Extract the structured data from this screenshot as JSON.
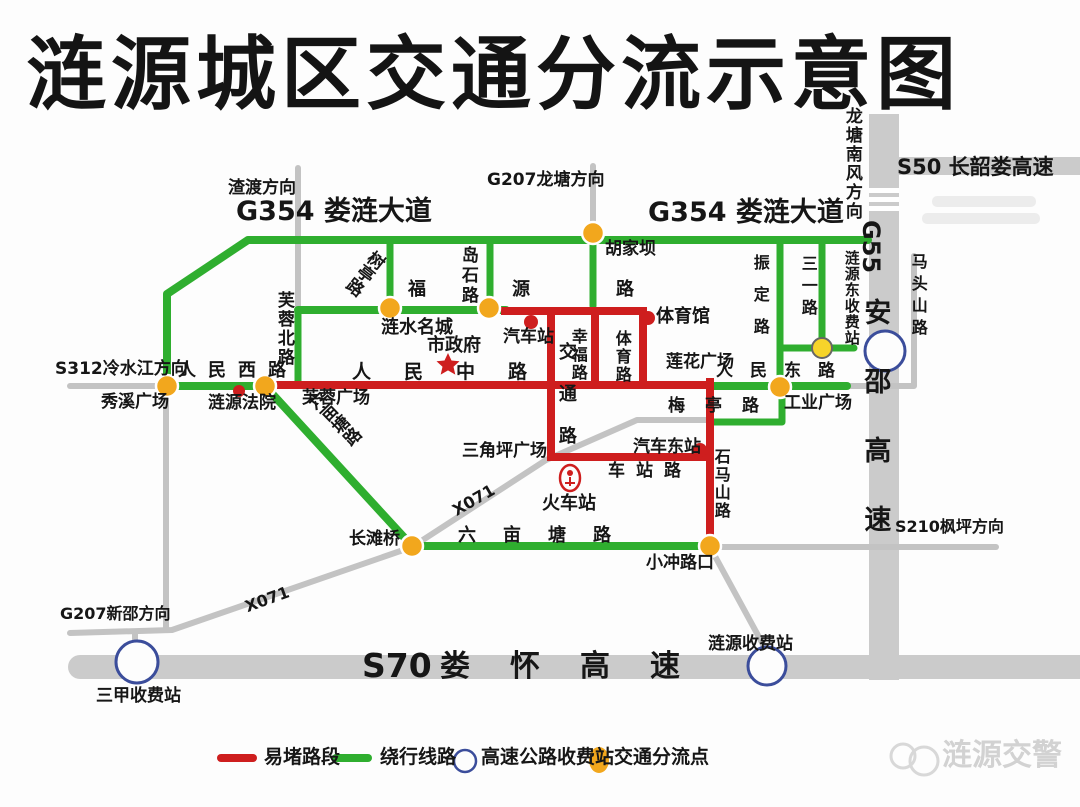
{
  "title": "涟源城区交通分流示意图",
  "colors": {
    "congested_red": "#ce1e1e",
    "detour_green": "#2fae2f",
    "highway_gray": "#cbcbcb",
    "minor_road_gray": "#c3c3c3",
    "diversion_orange": "#f2a71d",
    "toll_ring_blue": "#3b4d9b",
    "yellow_point": "#f6d42a"
  },
  "labels": {
    "zhadu_dir": "渣渡方向",
    "g354_left": "G354 娄涟大道",
    "g207_longtang": "G207龙塘方向",
    "g354_right": "G354 娄涟大道",
    "longtang_nanfeng": "龙塘南风方向",
    "s50": "S50 长韶娄高速",
    "hujiaba": "胡家坝",
    "shuting_rd": "树亭路",
    "daoshi_rd": "岛石路",
    "fuyuan_rd": "福源路",
    "lianshui_mingcheng": "涟水名城",
    "city_hall": "市政府",
    "bus_station": "汽车站",
    "gymnasium": "体育馆",
    "lianhua_square": "莲花广场",
    "furong_north_rd": "芙蓉北路",
    "s312": "S312冷水江方向",
    "renmin_west_rd": "人民西路",
    "xiuxi_square": "秀溪广场",
    "court": "涟源法院",
    "furong_square": "芙蓉广场",
    "renmin_middle_rd": "人民中路",
    "jiaotong_rd": "交通路",
    "xingfu_rd": "幸福路",
    "tiyu_rd": "体育路",
    "liumutang_rd_diag": "六亩塘路",
    "sanjiaoping_square": "三角坪广场",
    "x071_upper": "X071",
    "railway_station": "火车站",
    "chezhan_rd": "车站路",
    "auto_east_station": "汽车东站",
    "meiting_rd": "梅亭路",
    "gongye_square": "工业广场",
    "shimashan_rd": "石马山路",
    "renmin_east_rd": "人民东路",
    "zhending_rd": "振定路",
    "sanyi_rd": "三一路",
    "lianyuan_east_toll": "涟源东收费站",
    "g55": "G55",
    "anshao_expwy": "安邵高速",
    "matoushan_rd": "马头山路",
    "s210": "S210枫坪方向",
    "xiaochong_junction": "小冲路口",
    "liumutang_rd_h": "六亩塘路",
    "changtan_bridge": "长滩桥",
    "x071_lower": "X071",
    "g207_xinshao": "G207新邵方向",
    "sanjia_toll": "三甲收费站",
    "s70": "S70",
    "louhuai_expwy": "娄怀高速",
    "lianyuan_toll": "涟源收费站"
  },
  "legend": {
    "congested": "易堵路段",
    "detour": "绕行线路",
    "toll": "高速公路收费站",
    "diversion": "交通分流点"
  },
  "watermark": "涟源交警"
}
